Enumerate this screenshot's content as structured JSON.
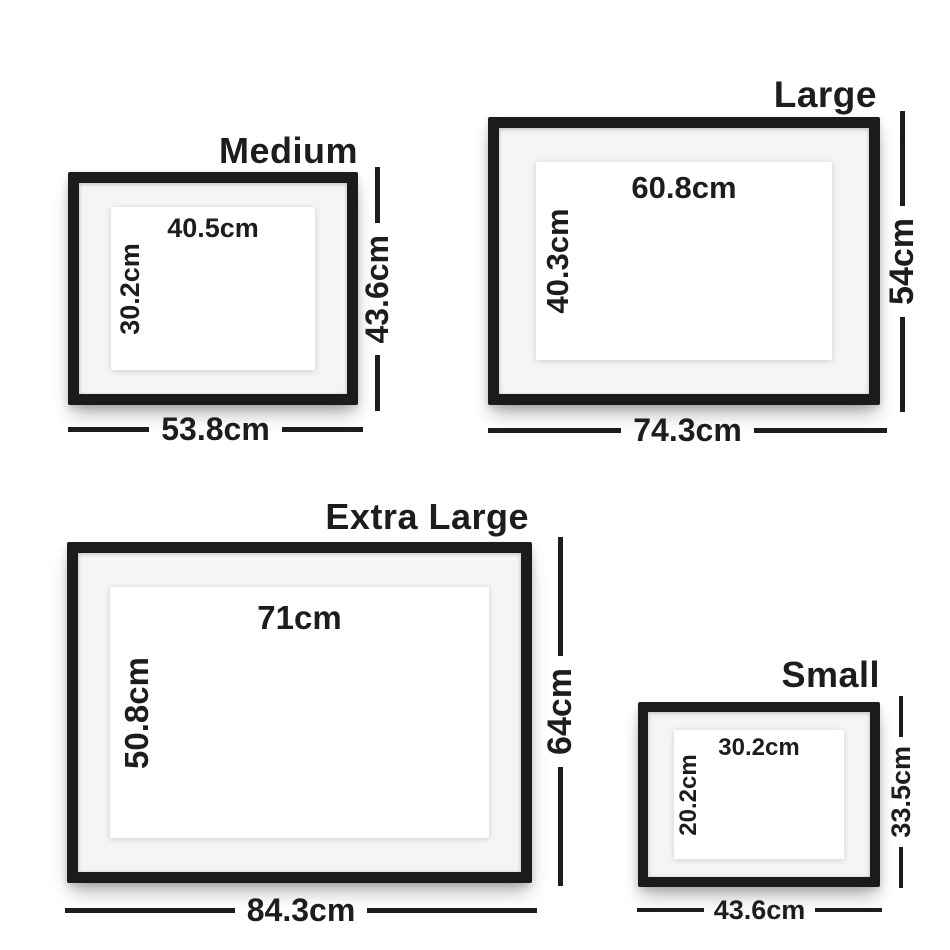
{
  "page": {
    "description": "Picture frame size guide diagram",
    "background": "#ffffff"
  },
  "colors": {
    "frame": "#1b1b1b",
    "mat": "#f5f5f5",
    "paper": "#ffffff",
    "text": "#1d1d1d",
    "dimension_line": "#1d1d1d"
  },
  "frames": [
    {
      "id": "medium",
      "title": "Medium",
      "print_width": "40.5cm",
      "print_height": "30.2cm",
      "frame_height": "43.6cm",
      "frame_width": "53.8cm"
    },
    {
      "id": "large",
      "title": "Large",
      "print_width": "60.8cm",
      "print_height": "40.3cm",
      "frame_height": "54cm",
      "frame_width": "74.3cm"
    },
    {
      "id": "extra-large",
      "title": "Extra Large",
      "print_width": "71cm",
      "print_height": "50.8cm",
      "frame_height": "64cm",
      "frame_width": "84.3cm"
    },
    {
      "id": "small",
      "title": "Small",
      "print_width": "30.2cm",
      "print_height": "20.2cm",
      "frame_height": "33.5cm",
      "frame_width": "43.6cm"
    }
  ]
}
